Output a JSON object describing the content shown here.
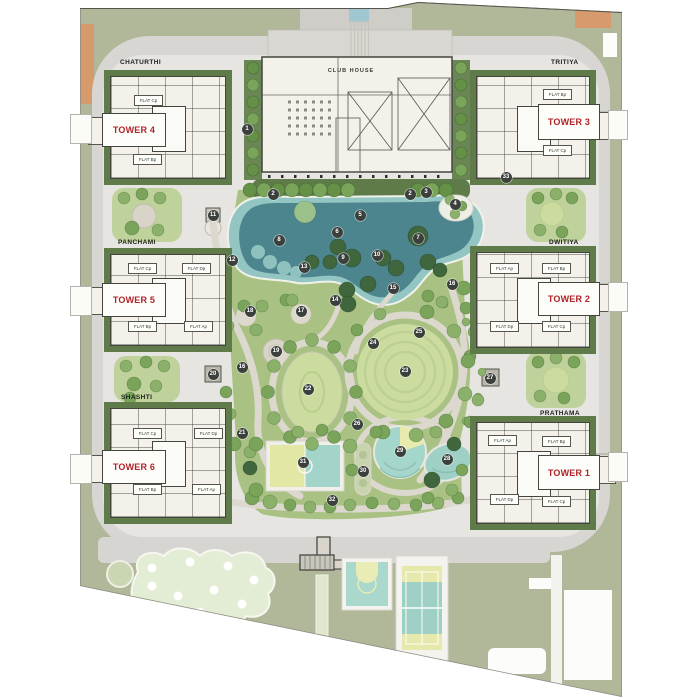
{
  "plan": {
    "clubhouse": {
      "label": "CLUB HOUSE"
    },
    "quarters": [
      {
        "name": "CHATURTHI"
      },
      {
        "name": "TRITIYA"
      },
      {
        "name": "PANCHAMI"
      },
      {
        "name": "DWITIYA"
      },
      {
        "name": "SHASHTI"
      },
      {
        "name": "PRATHAMA"
      }
    ],
    "towers": [
      {
        "name": "TOWER 4",
        "quarter": "CHATURTHI",
        "flats": [
          "FLAT Cp",
          "FLAT Bp"
        ]
      },
      {
        "name": "TOWER 3",
        "quarter": "TRITIYA",
        "flats": [
          "FLAT Bp",
          "FLAT Cp"
        ]
      },
      {
        "name": "TOWER 5",
        "quarter": "PANCHAMI",
        "flats": [
          "FLAT Cp",
          "FLAT Dp",
          "FLAT Bp",
          "FLAT Ap"
        ]
      },
      {
        "name": "TOWER 2",
        "quarter": "DWITIYA",
        "flats": [
          "FLAT Ap",
          "FLAT Bp",
          "FLAT Dp",
          "FLAT Cp"
        ]
      },
      {
        "name": "TOWER 6",
        "quarter": "SHASHTI",
        "flats": [
          "FLAT Cp",
          "FLAT Dp",
          "FLAT Bp",
          "FLAT Ap"
        ]
      },
      {
        "name": "TOWER 1",
        "quarter": "PRATHAMA",
        "flats": [
          "FLAT Ap",
          "FLAT Bp",
          "FLAT Dp",
          "FLAT Cp"
        ]
      }
    ],
    "markers": [
      {
        "n": "1",
        "x": 247,
        "y": 129
      },
      {
        "n": "2",
        "x": 273,
        "y": 194
      },
      {
        "n": "2",
        "x": 410,
        "y": 194
      },
      {
        "n": "3",
        "x": 426,
        "y": 192
      },
      {
        "n": "4",
        "x": 455,
        "y": 204
      },
      {
        "n": "5",
        "x": 360,
        "y": 215
      },
      {
        "n": "6",
        "x": 337,
        "y": 232
      },
      {
        "n": "7",
        "x": 418,
        "y": 238
      },
      {
        "n": "8",
        "x": 279,
        "y": 240
      },
      {
        "n": "9",
        "x": 343,
        "y": 258
      },
      {
        "n": "10",
        "x": 377,
        "y": 255
      },
      {
        "n": "11",
        "x": 213,
        "y": 215
      },
      {
        "n": "12",
        "x": 232,
        "y": 260
      },
      {
        "n": "13",
        "x": 304,
        "y": 267
      },
      {
        "n": "14",
        "x": 335,
        "y": 300
      },
      {
        "n": "15",
        "x": 393,
        "y": 288
      },
      {
        "n": "16",
        "x": 452,
        "y": 284
      },
      {
        "n": "16",
        "x": 242,
        "y": 367
      },
      {
        "n": "17",
        "x": 301,
        "y": 311
      },
      {
        "n": "18",
        "x": 250,
        "y": 311
      },
      {
        "n": "19",
        "x": 276,
        "y": 351
      },
      {
        "n": "20",
        "x": 213,
        "y": 374
      },
      {
        "n": "21",
        "x": 242,
        "y": 433
      },
      {
        "n": "22",
        "x": 308,
        "y": 389
      },
      {
        "n": "23",
        "x": 405,
        "y": 371
      },
      {
        "n": "24",
        "x": 373,
        "y": 343
      },
      {
        "n": "25",
        "x": 419,
        "y": 332
      },
      {
        "n": "26",
        "x": 357,
        "y": 424
      },
      {
        "n": "27",
        "x": 490,
        "y": 378
      },
      {
        "n": "28",
        "x": 447,
        "y": 459
      },
      {
        "n": "29",
        "x": 400,
        "y": 451
      },
      {
        "n": "30",
        "x": 363,
        "y": 471
      },
      {
        "n": "31",
        "x": 303,
        "y": 462
      },
      {
        "n": "32",
        "x": 332,
        "y": 500
      },
      {
        "n": "33",
        "x": 506,
        "y": 177
      }
    ],
    "colors": {
      "tower_label_red": "#b0232a",
      "site_olive": "#b1b899",
      "road_gray": "#d8d6d2",
      "water_deep": "#4c858d",
      "water_light": "#93c6c2",
      "garden_green": "#a9c183",
      "accent_orange": "#d69a6c",
      "building_cream": "#f3f1ea"
    }
  }
}
